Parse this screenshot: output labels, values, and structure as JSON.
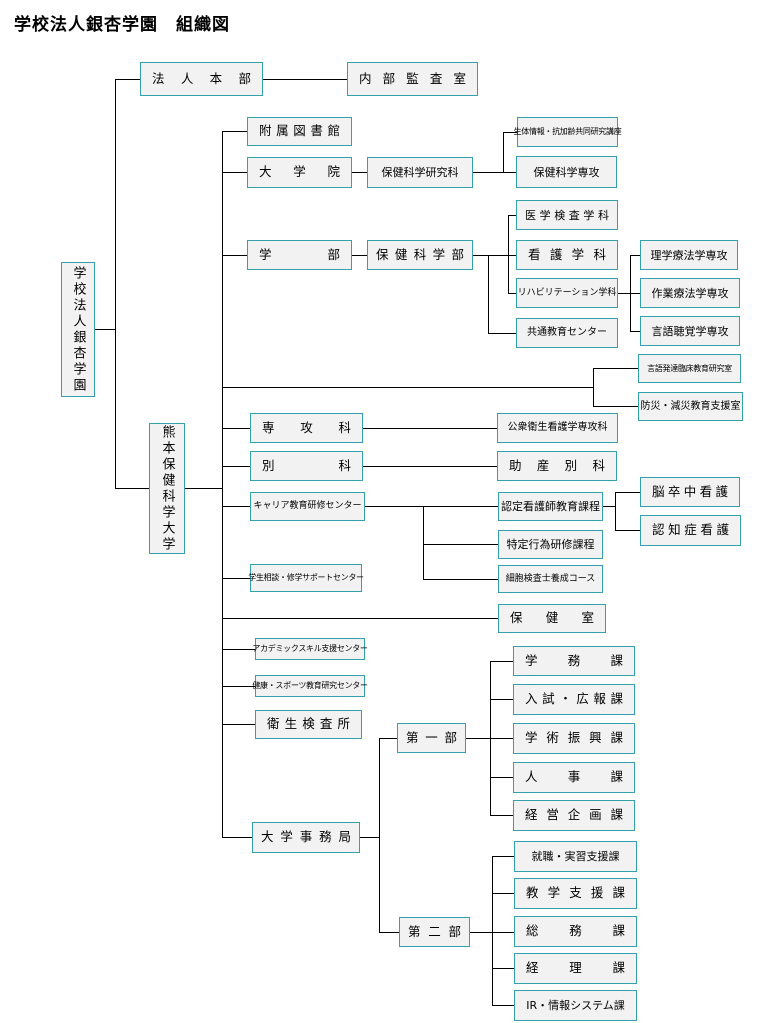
{
  "title": "学校法人銀杏学園　組織図",
  "colors": {
    "box_border": "#33A0AC",
    "box_fill": "#F2F2F2",
    "line": "#000000",
    "text": "#000000"
  },
  "nodes": {
    "gakkou_houjin": "学校法人銀杏学園",
    "houjin_honbu": "法人本部",
    "naibu_kansashitsu": "内部監査室",
    "kumamoto_univ": "熊本保健科学大学",
    "fuzoku_toshokan": "附属図書館",
    "daigakuin": "大学院",
    "hoken_kagaku_kenkyuka": "保健科学研究科",
    "seitai_kouza": "生体情報・抗加齢共同研究講座",
    "hoken_kagaku_senkou": "保健科学専攻",
    "gakubu": "学部",
    "hoken_kagakubu": "保健科学部",
    "igaku_kensa_gakka": "医学検査学科",
    "kango_gakka": "看護学科",
    "rehabilitation_gakka": "リハビリテーション学科",
    "kyotsu_kyoiku_center": "共通教育センター",
    "rigaku_ryoho": "理学療法学専攻",
    "sagyo_ryoho": "作業療法学専攻",
    "gengo_chokaku": "言語聴覚学専攻",
    "gengo_hattatsu": "言語発達臨床教育研究室",
    "bosai_gensai": "防災・減災教育支援室",
    "senkoka": "専攻科",
    "koshu_eisei": "公衆衛生看護学専攻科",
    "bekka": "別科",
    "josan_bekka": "助産別科",
    "career_center": "キャリア教育研修センター",
    "nintei_kangoshi": "認定看護師教育課程",
    "nosocchu_kango": "脳卒中看護",
    "ninchisho_kango": "認知症看護",
    "tokutei_koi": "特定行為研修課程",
    "saibo_kensashi": "細胞検査士養成コース",
    "gakusei_sodan": "学生相談・修学サポートセンター",
    "hokenshitsu": "保健室",
    "academic_skill": "アカデミックスキル支援センター",
    "kenko_sports": "健康・スポーツ教育研究センター",
    "eisei_kensajo": "衛生検査所",
    "daigaku_jimukyoku": "大学事務局",
    "dai_ichibu": "第一部",
    "gakumuka": "学務課",
    "nyushi_kohoka": "入試・広報課",
    "gakujutsu_shinkoka": "学術振興課",
    "jinjika": "人事課",
    "keiei_kikakuka": "経営企画課",
    "dai_nibu": "第二部",
    "shushoku_jisshu": "就職・実習支援課",
    "kyogaku_shienka": "教学支援課",
    "somuka": "総務課",
    "keirika": "経理課",
    "ir_joho_system": "IR・情報システム課"
  }
}
